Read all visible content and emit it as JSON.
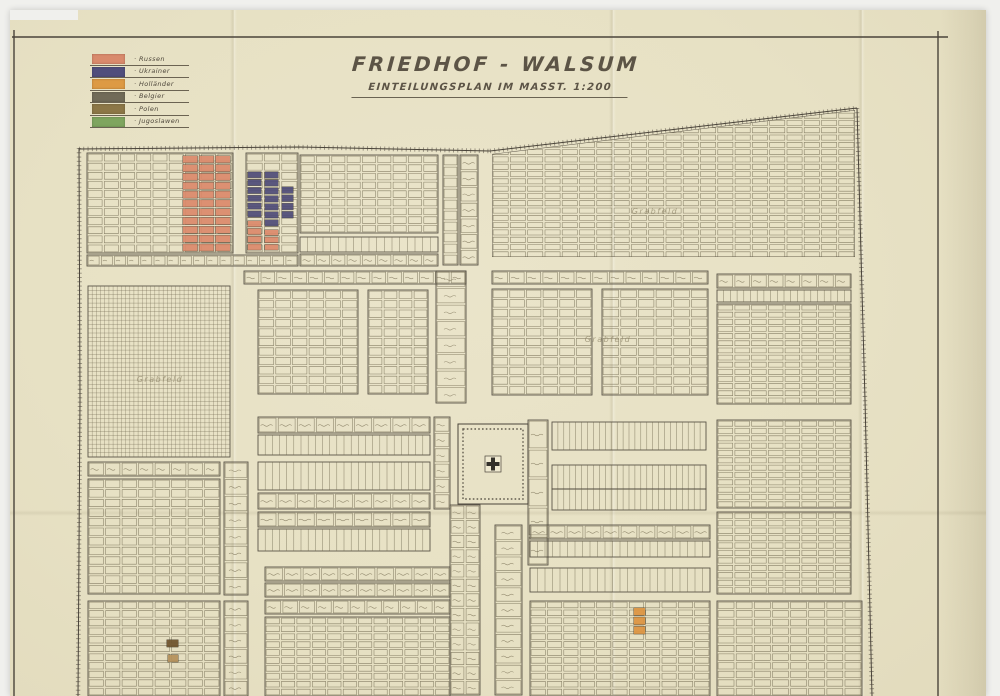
{
  "document": {
    "title": "FRIEDHOF - WALSUM",
    "subtitle": "EINTEILUNGSPLAN IM MASST. 1:200"
  },
  "legend": {
    "items": [
      {
        "label": "Russen",
        "color": "#d98a6c"
      },
      {
        "label": "Ukrainer",
        "color": "#504e7c"
      },
      {
        "label": "Holländer",
        "color": "#dd9a44"
      },
      {
        "label": "Belgier",
        "color": "#716b58"
      },
      {
        "label": "Polen",
        "color": "#8c7747"
      },
      {
        "label": "Jugoslawen",
        "color": "#7fa55f"
      }
    ]
  },
  "map": {
    "paper_color": "#e8e2c6",
    "ink_color": "#4a443a",
    "plot_stroke": "#6e664e",
    "pencil_color": "#8f8568",
    "memorial_symbol": "cross",
    "field_labels": [
      {
        "text": "Grabfeld",
        "x": 655,
        "y": 214
      },
      {
        "text": "Grabfeld",
        "x": 160,
        "y": 382
      },
      {
        "text": "Grabfeld",
        "x": 608,
        "y": 342
      }
    ],
    "blocks": [
      {
        "t": "cells",
        "x": 87,
        "y": 153,
        "w": 146,
        "h": 100,
        "cols": 9,
        "rows": 11
      },
      {
        "t": "cells",
        "x": 246,
        "y": 153,
        "w": 52,
        "h": 100,
        "cols": 3,
        "rows": 11
      },
      {
        "t": "cells",
        "x": 87,
        "y": 255,
        "w": 211,
        "h": 11,
        "cols": 16,
        "rows": 1,
        "script": true
      },
      {
        "t": "cells",
        "x": 300,
        "y": 155,
        "w": 138,
        "h": 78,
        "cols": 9,
        "rows": 9
      },
      {
        "t": "comb",
        "x": 300,
        "y": 237,
        "w": 138,
        "h": 15,
        "cols": 18
      },
      {
        "t": "cells",
        "x": 300,
        "y": 254,
        "w": 138,
        "h": 12,
        "cols": 9,
        "rows": 1,
        "script": true
      },
      {
        "t": "cells",
        "x": 443,
        "y": 155,
        "w": 15,
        "h": 110,
        "cols": 1,
        "rows": 10
      },
      {
        "t": "cells",
        "x": 460,
        "y": 155,
        "w": 18,
        "h": 110,
        "cols": 1,
        "rows": 7,
        "script": true
      },
      {
        "t": "cells",
        "x": 492,
        "y": 112,
        "w": 363,
        "h": 146,
        "cols": 21,
        "rows": 20,
        "clip": [
          [
            492,
            154
          ],
          [
            855,
            110
          ],
          [
            855,
            257
          ],
          [
            492,
            257
          ]
        ]
      },
      {
        "t": "hatch",
        "x": 88,
        "y": 286,
        "w": 142,
        "h": 171,
        "cols": 34,
        "rows": 40
      },
      {
        "t": "cells",
        "x": 244,
        "y": 271,
        "w": 222,
        "h": 13,
        "cols": 14,
        "rows": 1,
        "script": true
      },
      {
        "t": "cells",
        "x": 258,
        "y": 290,
        "w": 100,
        "h": 104,
        "cols": 6,
        "rows": 11
      },
      {
        "t": "cells",
        "x": 368,
        "y": 290,
        "w": 60,
        "h": 104,
        "cols": 4,
        "rows": 11
      },
      {
        "t": "cells",
        "x": 436,
        "y": 271,
        "w": 30,
        "h": 132,
        "cols": 1,
        "rows": 8,
        "script": true
      },
      {
        "t": "cells",
        "x": 492,
        "y": 271,
        "w": 216,
        "h": 13,
        "cols": 13,
        "rows": 1,
        "script": true
      },
      {
        "t": "cells",
        "x": 492,
        "y": 289,
        "w": 100,
        "h": 106,
        "cols": 6,
        "rows": 11
      },
      {
        "t": "cells",
        "x": 602,
        "y": 289,
        "w": 106,
        "h": 106,
        "cols": 6,
        "rows": 11
      },
      {
        "t": "cells",
        "x": 717,
        "y": 274,
        "w": 134,
        "h": 14,
        "cols": 8,
        "rows": 1,
        "script": true
      },
      {
        "t": "comb",
        "x": 717,
        "y": 290,
        "w": 134,
        "h": 12,
        "cols": 20
      },
      {
        "t": "cells",
        "x": 717,
        "y": 304,
        "w": 134,
        "h": 100,
        "cols": 8,
        "rows": 14
      },
      {
        "t": "cells",
        "x": 258,
        "y": 417,
        "w": 172,
        "h": 16,
        "cols": 9,
        "rows": 1,
        "script": true
      },
      {
        "t": "comb",
        "x": 258,
        "y": 435,
        "w": 172,
        "h": 20,
        "cols": 24
      },
      {
        "t": "comb",
        "x": 258,
        "y": 462,
        "w": 172,
        "h": 28,
        "cols": 24
      },
      {
        "t": "cells",
        "x": 258,
        "y": 493,
        "w": 172,
        "h": 16,
        "cols": 9,
        "rows": 1,
        "script": true
      },
      {
        "t": "cells",
        "x": 434,
        "y": 417,
        "w": 16,
        "h": 92,
        "cols": 1,
        "rows": 6,
        "script": true
      },
      {
        "t": "memorial",
        "x": 458,
        "y": 424,
        "w": 70,
        "h": 80
      },
      {
        "t": "cells",
        "x": 528,
        "y": 420,
        "w": 20,
        "h": 145,
        "cols": 1,
        "rows": 5,
        "script": true
      },
      {
        "t": "comb",
        "x": 552,
        "y": 422,
        "w": 154,
        "h": 28,
        "cols": 26
      },
      {
        "t": "comb",
        "x": 552,
        "y": 465,
        "w": 154,
        "h": 24,
        "cols": 26
      },
      {
        "t": "comb",
        "x": 552,
        "y": 489,
        "w": 154,
        "h": 21,
        "cols": 26
      },
      {
        "t": "cells",
        "x": 717,
        "y": 420,
        "w": 134,
        "h": 88,
        "cols": 8,
        "rows": 12
      },
      {
        "t": "cells",
        "x": 88,
        "y": 462,
        "w": 132,
        "h": 14,
        "cols": 8,
        "rows": 1,
        "script": true
      },
      {
        "t": "cells",
        "x": 88,
        "y": 479,
        "w": 132,
        "h": 115,
        "cols": 8,
        "rows": 12
      },
      {
        "t": "cells",
        "x": 224,
        "y": 462,
        "w": 24,
        "h": 133,
        "cols": 1,
        "rows": 8,
        "script": true
      },
      {
        "t": "cells",
        "x": 258,
        "y": 512,
        "w": 172,
        "h": 15,
        "cols": 9,
        "rows": 1,
        "script": true
      },
      {
        "t": "comb",
        "x": 258,
        "y": 529,
        "w": 172,
        "h": 22,
        "cols": 24
      },
      {
        "t": "cells",
        "x": 265,
        "y": 567,
        "w": 185,
        "h": 14,
        "cols": 10,
        "rows": 1,
        "script": true
      },
      {
        "t": "cells",
        "x": 265,
        "y": 583,
        "w": 185,
        "h": 14,
        "cols": 10,
        "rows": 1,
        "script": true
      },
      {
        "t": "cells",
        "x": 450,
        "y": 505,
        "w": 30,
        "h": 190,
        "cols": 2,
        "rows": 13,
        "script": true
      },
      {
        "t": "cells",
        "x": 495,
        "y": 525,
        "w": 27,
        "h": 170,
        "cols": 1,
        "rows": 11,
        "script": true
      },
      {
        "t": "cells",
        "x": 530,
        "y": 525,
        "w": 180,
        "h": 14,
        "cols": 10,
        "rows": 1,
        "script": true
      },
      {
        "t": "comb",
        "x": 530,
        "y": 541,
        "w": 180,
        "h": 16,
        "cols": 24
      },
      {
        "t": "comb",
        "x": 530,
        "y": 568,
        "w": 180,
        "h": 24,
        "cols": 24
      },
      {
        "t": "cells",
        "x": 717,
        "y": 512,
        "w": 134,
        "h": 82,
        "cols": 8,
        "rows": 11
      },
      {
        "t": "cells",
        "x": 88,
        "y": 601,
        "w": 132,
        "h": 95,
        "cols": 8,
        "rows": 11
      },
      {
        "t": "cells",
        "x": 224,
        "y": 601,
        "w": 24,
        "h": 95,
        "cols": 1,
        "rows": 6,
        "script": true
      },
      {
        "t": "cells",
        "x": 265,
        "y": 600,
        "w": 185,
        "h": 14,
        "cols": 11,
        "rows": 1,
        "script": true
      },
      {
        "t": "cells",
        "x": 265,
        "y": 617,
        "w": 185,
        "h": 79,
        "cols": 12,
        "rows": 10
      },
      {
        "t": "cells",
        "x": 530,
        "y": 601,
        "w": 180,
        "h": 95,
        "cols": 11,
        "rows": 12
      },
      {
        "t": "cells",
        "x": 717,
        "y": 601,
        "w": 145,
        "h": 95,
        "cols": 8,
        "rows": 11
      }
    ],
    "colored_grave_groups": [
      {
        "x": 182,
        "y": 155,
        "w": 49,
        "h": 97,
        "cols": 3,
        "rows": 11,
        "color": "#dc8a6b",
        "group": "Russen"
      },
      {
        "x": 247,
        "y": 171,
        "w": 15,
        "h": 47,
        "cols": 1,
        "rows": 6,
        "color": "#4e4c78",
        "group": "Ukrainer"
      },
      {
        "x": 264,
        "y": 171,
        "w": 15,
        "h": 56,
        "cols": 1,
        "rows": 7,
        "color": "#4e4c78",
        "group": "Ukrainer"
      },
      {
        "x": 281,
        "y": 186,
        "w": 13,
        "h": 33,
        "cols": 1,
        "rows": 4,
        "color": "#4e4c78",
        "group": "Ukrainer"
      },
      {
        "x": 247,
        "y": 220,
        "w": 15,
        "h": 31,
        "cols": 1,
        "rows": 4,
        "color": "#dc8a6b",
        "group": "Russen"
      },
      {
        "x": 264,
        "y": 229,
        "w": 15,
        "h": 22,
        "cols": 1,
        "rows": 3,
        "color": "#dc8a6b",
        "group": "Russen"
      },
      {
        "x": 633,
        "y": 607,
        "w": 13,
        "h": 28,
        "cols": 1,
        "rows": 3,
        "color": "#dd9440",
        "group": "Holländer"
      },
      {
        "x": 166,
        "y": 639,
        "w": 13,
        "h": 9,
        "cols": 1,
        "rows": 1,
        "color": "#6e532c",
        "group": "Polen"
      },
      {
        "x": 167,
        "y": 654,
        "w": 12,
        "h": 9,
        "cols": 1,
        "rows": 1,
        "color": "#b5905a",
        "group": "Polen"
      }
    ]
  }
}
